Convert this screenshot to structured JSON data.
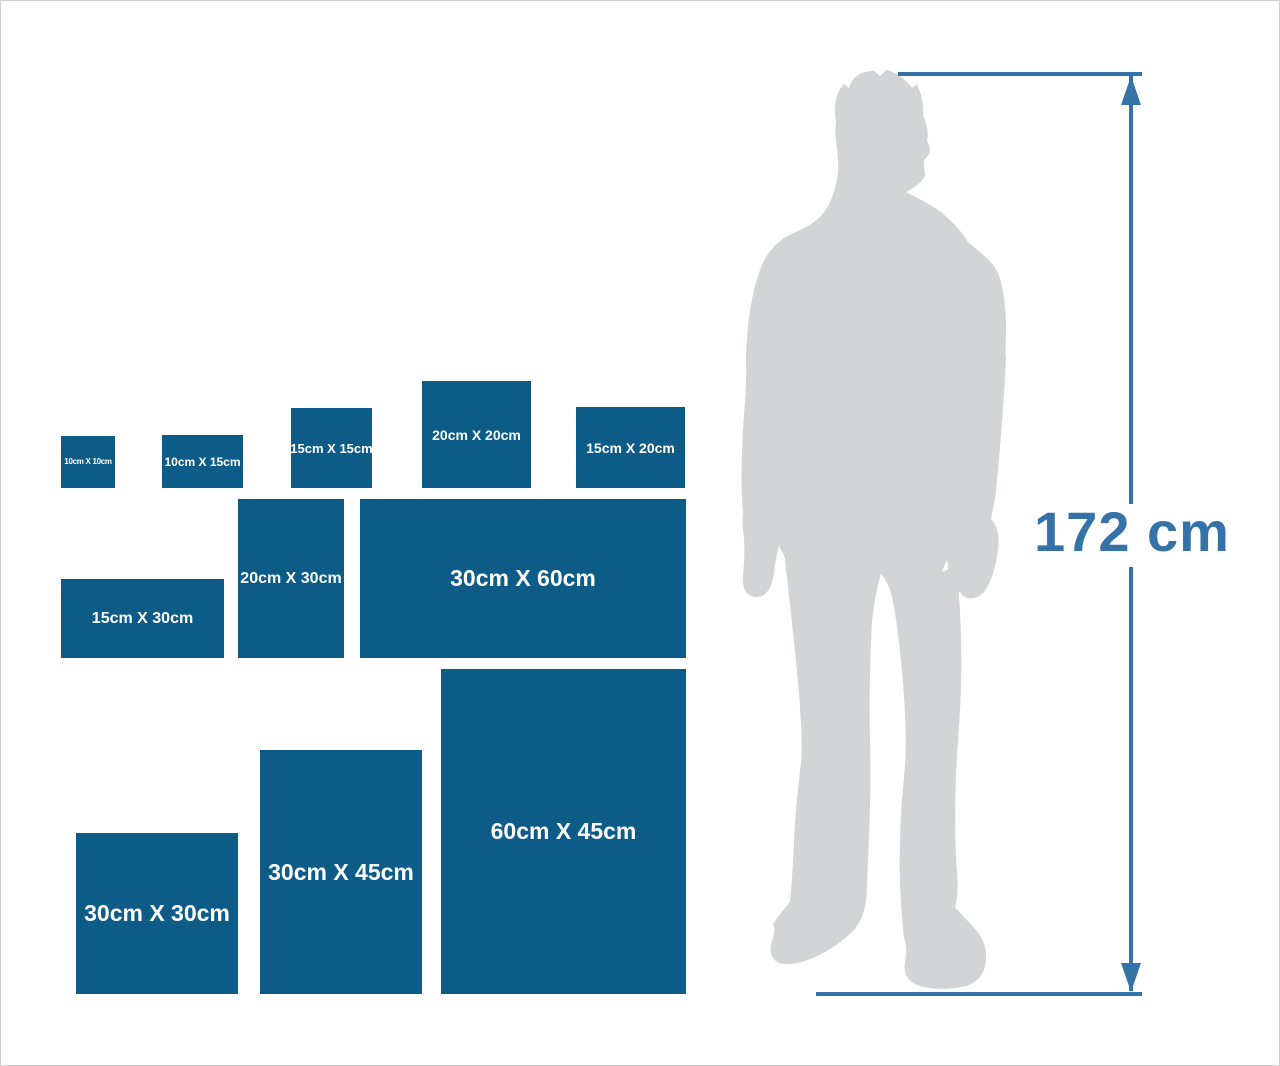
{
  "colors": {
    "box-blue": "#0D5C88",
    "label-white": "#FFFFFF",
    "silhouette-gray": "#D2D4D6",
    "measure-blue": "#3572A7",
    "page-border": "#CFCFCF"
  },
  "size_boxes": [
    {
      "label": "10cm X 10cm",
      "width_cm": 10,
      "height_cm": 10
    },
    {
      "label": "10cm X 15cm",
      "width_cm": 15,
      "height_cm": 10
    },
    {
      "label": "15cm X 15cm",
      "width_cm": 15,
      "height_cm": 15
    },
    {
      "label": "20cm X 20cm",
      "width_cm": 20,
      "height_cm": 20
    },
    {
      "label": "15cm X 20cm",
      "width_cm": 20,
      "height_cm": 15
    },
    {
      "label": "15cm X 30cm",
      "width_cm": 30,
      "height_cm": 15
    },
    {
      "label": "20cm X 30cm",
      "width_cm": 20,
      "height_cm": 30
    },
    {
      "label": "30cm X 60cm",
      "width_cm": 60,
      "height_cm": 30
    },
    {
      "label": "30cm X 30cm",
      "width_cm": 30,
      "height_cm": 30
    },
    {
      "label": "30cm X 45cm",
      "width_cm": 30,
      "height_cm": 45
    },
    {
      "label": "60cm X 45cm",
      "width_cm": 45,
      "height_cm": 60
    }
  ],
  "measurement": {
    "height_label": "172 cm"
  }
}
